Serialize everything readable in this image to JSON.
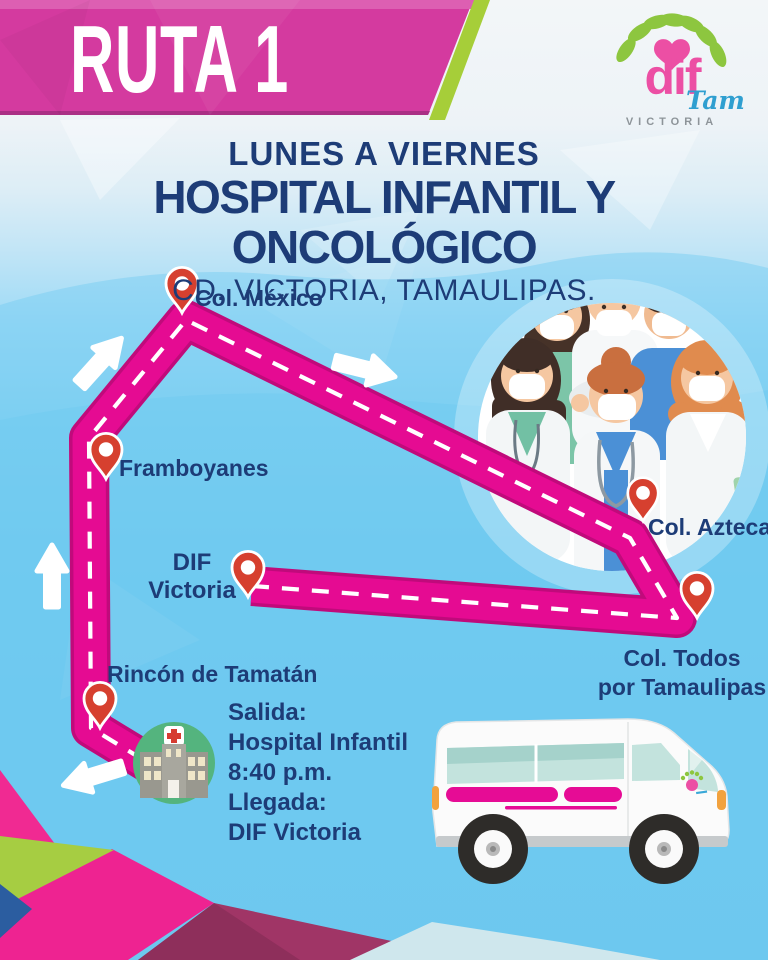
{
  "banner": {
    "route": "RUTA 1"
  },
  "logo": {
    "dif": "dif",
    "tam": "Tam",
    "victoria": "VICTORIA"
  },
  "title": {
    "days": "LUNES A VIERNES",
    "main": "HOSPITAL INFANTIL Y ONCOLÓGICO",
    "city": "CD. VICTORIA, TAMAULIPAS."
  },
  "stops": [
    {
      "id": "col-mexico",
      "label": "Col. México"
    },
    {
      "id": "framboyanes",
      "label": "Framboyanes"
    },
    {
      "id": "dif-victoria",
      "label": "DIF",
      "label2": "Victoria"
    },
    {
      "id": "rincon-de-tamatan",
      "label": "Rincón de Tamatán"
    },
    {
      "id": "col-azteca",
      "label": "Col. Azteca"
    },
    {
      "id": "col-todos-por-tamaulipas",
      "label": "Col. Todos",
      "label2": "por Tamaulipas"
    }
  ],
  "schedule": {
    "salida_label": "Salida:",
    "salida_place": "Hospital Infantil",
    "salida_time": "8:40 p.m.",
    "llegada_label": "Llegada:",
    "llegada_place": "DIF Victoria"
  },
  "colors": {
    "banner_magenta": "#d43a9f",
    "accent_green": "#a6ce39",
    "route_pink": "#e50b92",
    "navy_text": "#1d3c77",
    "pin_red": "#d6402f",
    "sky_blue": "#63c4ee"
  }
}
